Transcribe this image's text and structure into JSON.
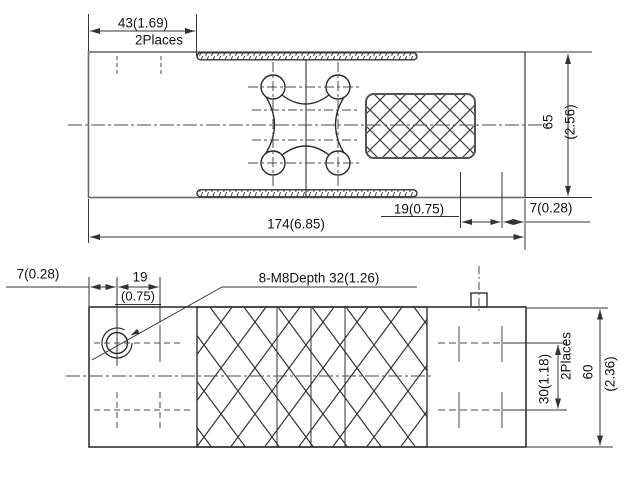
{
  "drawing": {
    "type": "technical-outline-drawing",
    "colors": {
      "line": "#3a3a3a",
      "thin_line": "#555555",
      "background": "#ffffff"
    },
    "top_view": {
      "dim_43": "43(1.69)",
      "note_2places": "2Places",
      "dim_174": "174(6.85)",
      "dim_19": "19(0.75)",
      "dim_7": "7(0.28)",
      "dim_65_mm": "65",
      "dim_65_in": "(2.56)"
    },
    "bottom_view": {
      "dim_7": "7(0.28)",
      "dim_19_mm": "19",
      "dim_19_in": "(0.75)",
      "thread_callout": "8-M8Depth 32(1.26)",
      "dim_30": "30(1.18)",
      "note_2places": "2Places",
      "dim_60_mm": "60",
      "dim_60_in": "(2.36)"
    }
  }
}
